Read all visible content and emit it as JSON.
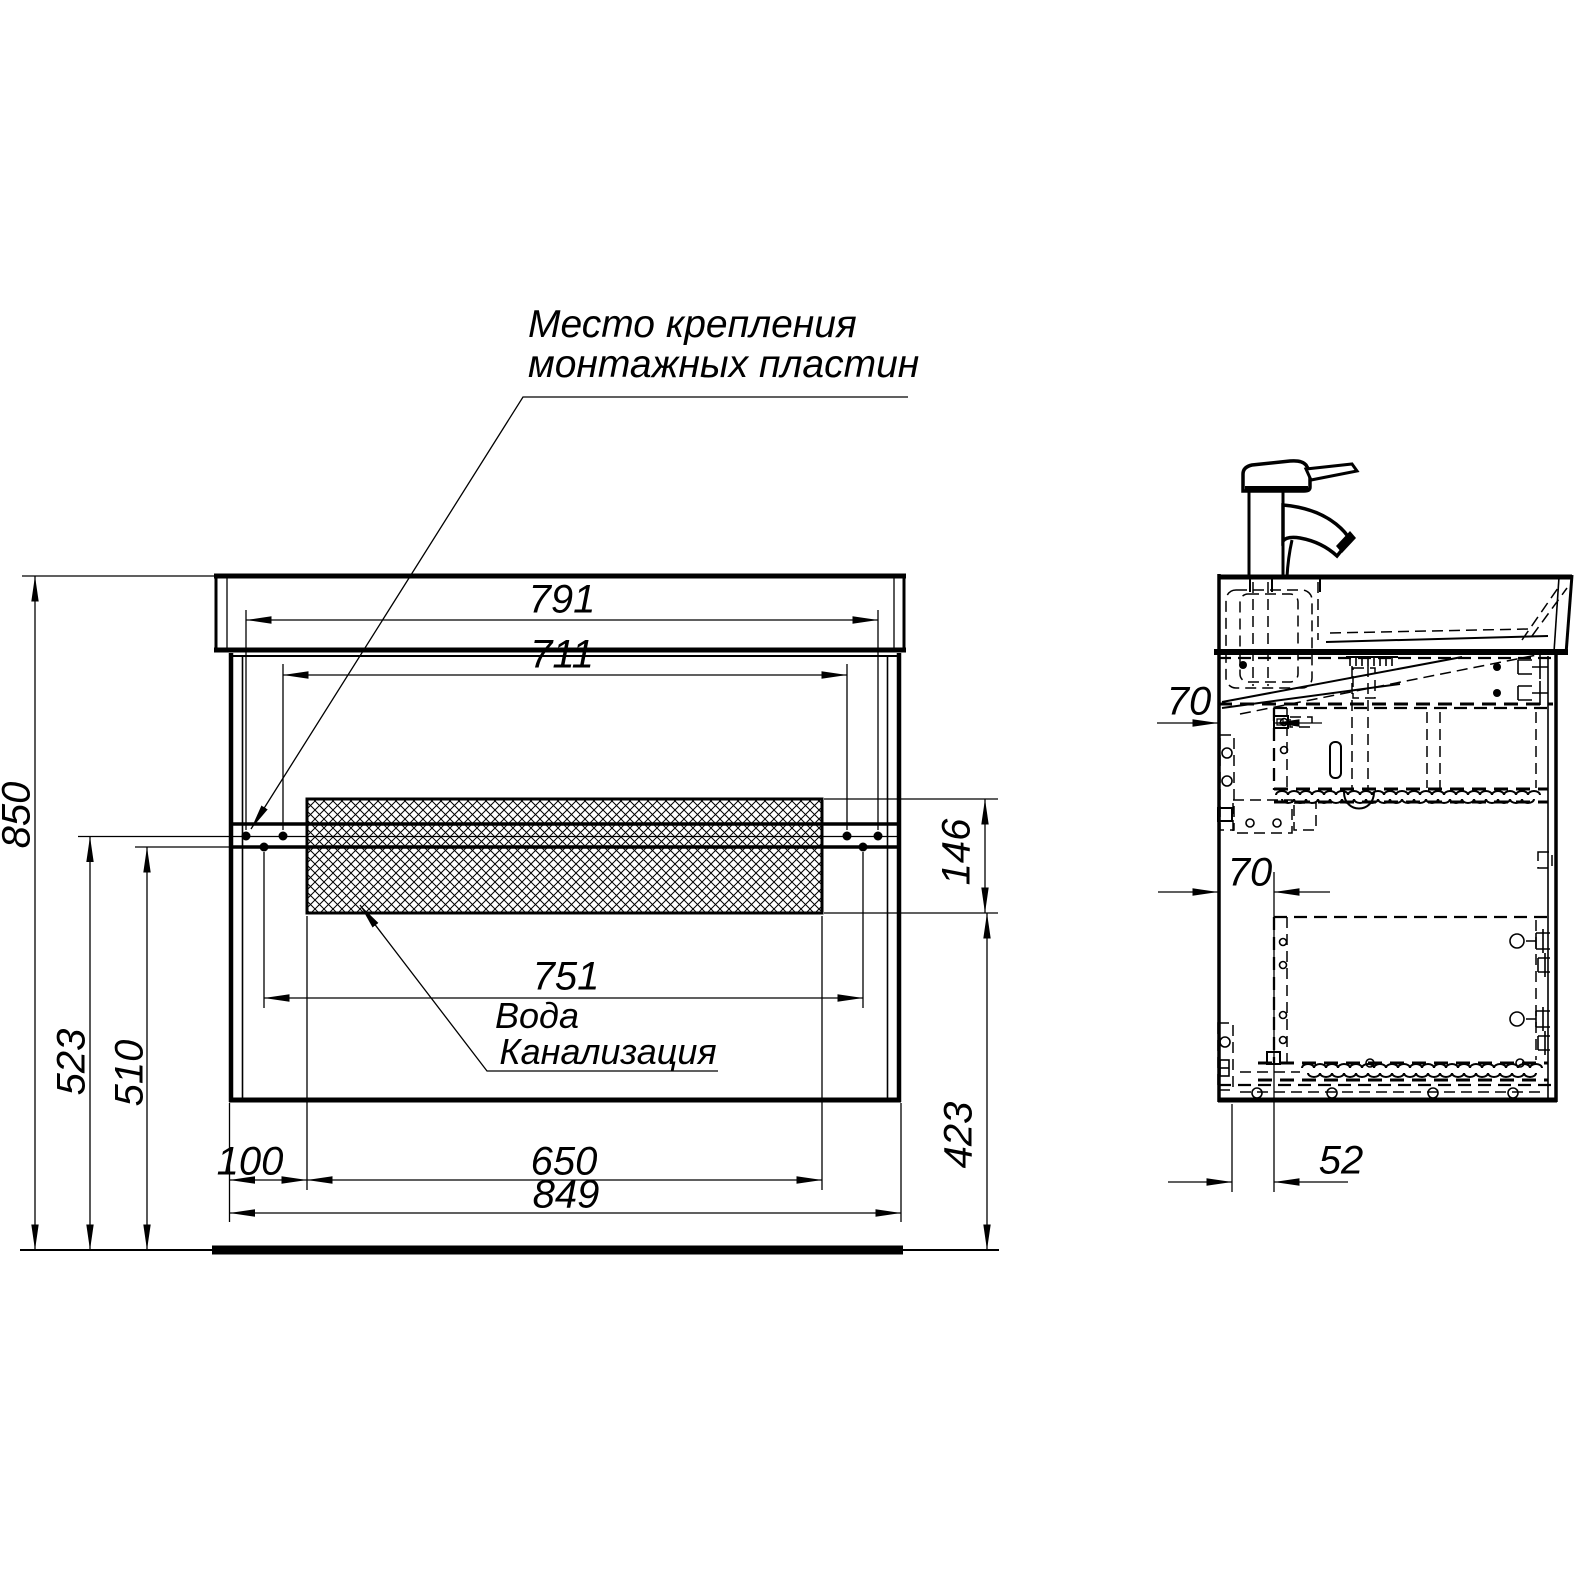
{
  "annotations": {
    "mounting_note_line1": "Место крепления",
    "mounting_note_line2": "монтажных пластин",
    "water_label": "Вода",
    "sewer_label": "Канализация"
  },
  "front_view": {
    "dims": {
      "top_width": "791",
      "inner_width": "711",
      "plate_width": "751",
      "hatch_width": "650",
      "left_offset": "100",
      "cabinet_width": "849",
      "total_height": "850",
      "plate_height_upper": "523",
      "plate_height_lower": "510",
      "hatch_band_height": "146",
      "bottom_clearance": "423"
    }
  },
  "side_view": {
    "dims": {
      "plate_depth_top": "70",
      "plate_depth_mid": "70",
      "bottom_inset": "52"
    }
  },
  "colors": {
    "line": "#000000",
    "background": "#ffffff"
  }
}
